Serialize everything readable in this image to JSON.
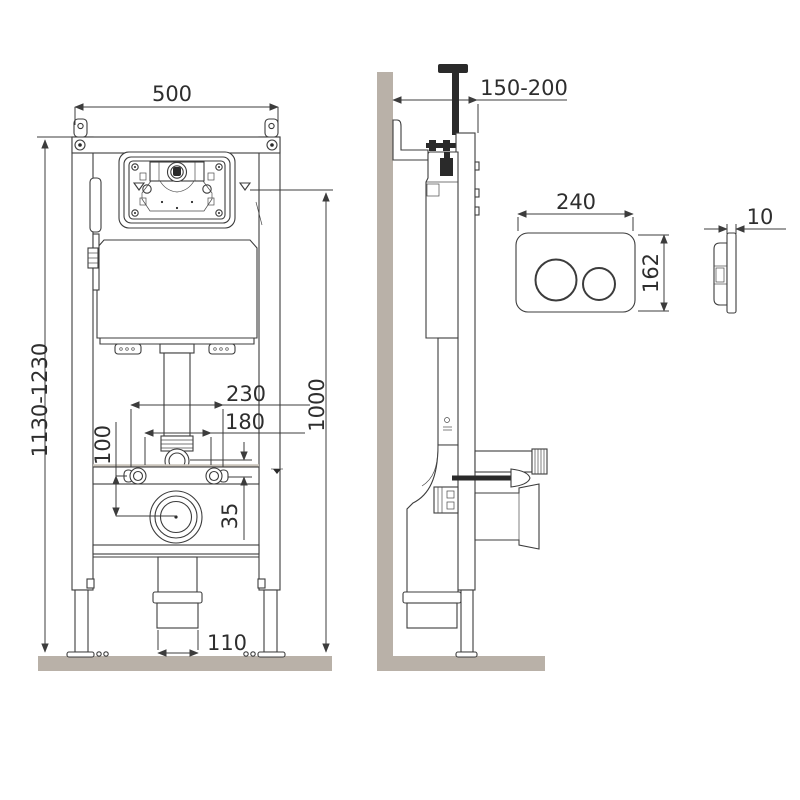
{
  "colors": {
    "line": "#3c3c3c",
    "dark_fill": "#2a2a2a",
    "wall_floor": "#b9b1a8",
    "background": "#ffffff"
  },
  "front_view": {
    "frame_width": "500",
    "frame_height_range": "1130-1230",
    "flush_axis_height": "1000",
    "upper_span": "230",
    "bolt_spacing": "180",
    "bolt_to_outlet": "100",
    "axis_offset": "35",
    "outlet_pipe_width": "110"
  },
  "side_view": {
    "wall_distance_range": "150-200"
  },
  "flush_plate": {
    "width": "240",
    "height": "162",
    "thickness": "10"
  }
}
